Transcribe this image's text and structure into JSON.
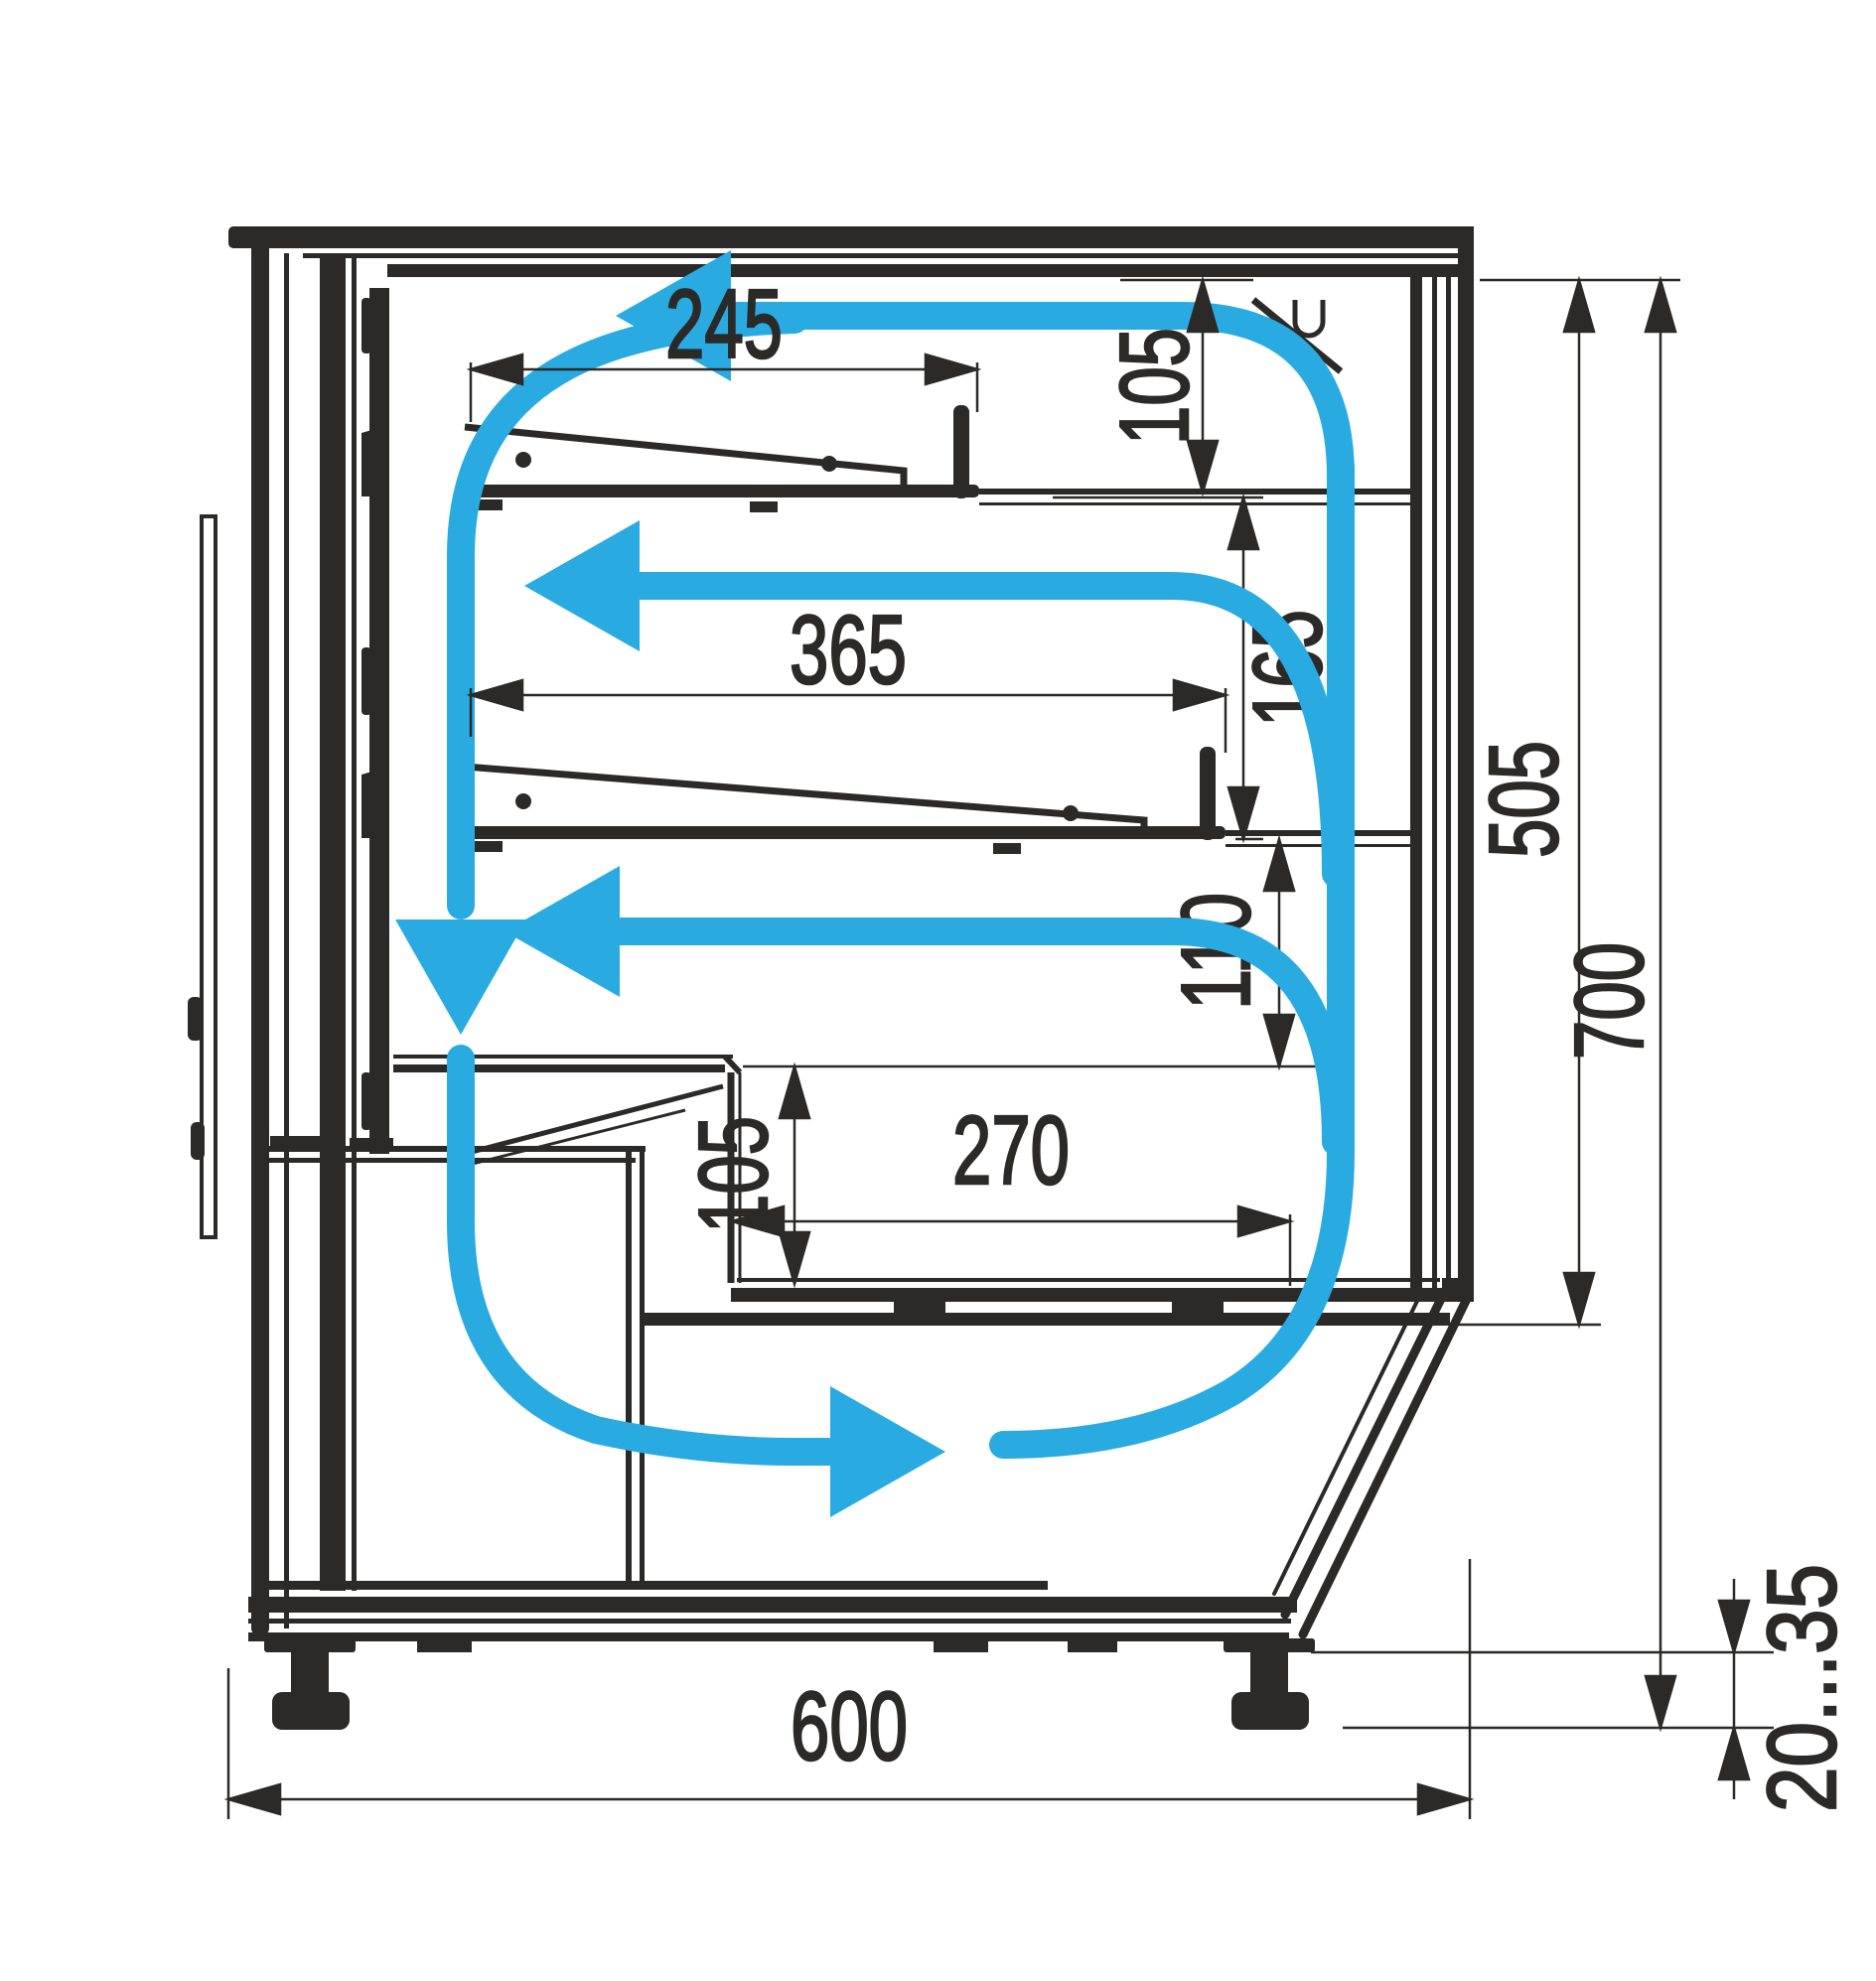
{
  "diagram": {
    "type": "technical-cross-section",
    "subject": "refrigerated display case side section with air circulation",
    "colors": {
      "line": "#2B2A29",
      "airflow": "#29ABE2",
      "background": "#FFFFFF"
    },
    "dims": {
      "shelf1_length": "245",
      "top_clearance": "105",
      "shelf2_length": "365",
      "shelf_gap": "165",
      "inner_height": "505",
      "overall_height": "700",
      "counter_clearance": "110",
      "well_depth": "105",
      "well_length": "270",
      "base_depth": "600",
      "foot_range": "20...35"
    }
  }
}
